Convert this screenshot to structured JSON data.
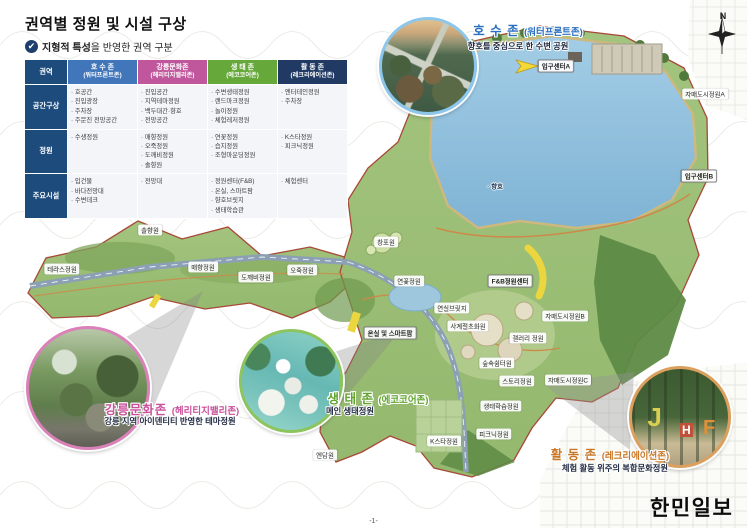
{
  "page": {
    "title": "권역별 정원 및 시설 구상",
    "subtitle_bold": "지형적 특성",
    "subtitle_rest": "을 반영한 권역 구분",
    "check": "✔",
    "compass_n": "N",
    "page_number": "-1-",
    "logo": "한민일보"
  },
  "table": {
    "corner": "권역",
    "rows": [
      "공간구상",
      "정원",
      "주요시설"
    ],
    "zones": [
      {
        "name": "호 수 존",
        "subname": "(워터프론트존)",
        "header_color": "#4276ba",
        "space": [
          "호공간",
          "진입광장",
          "주차장",
          "주문진 전망공간"
        ],
        "gardens": [
          "수생정원"
        ],
        "facilities": [
          "입건물",
          "바다전망대",
          "수변데크"
        ]
      },
      {
        "name": "강릉문화존",
        "subname": "(헤리티지밸리존)",
        "header_color": "#c0569c",
        "space": [
          "진입공간",
          "지역테마정원",
          "백두대간·향호",
          "전망공간"
        ],
        "gardens": [
          "매향정원",
          "오죽정원",
          "도깨비정원",
          "솔향원"
        ],
        "facilities": [
          "전망대"
        ]
      },
      {
        "name": "생 태 존",
        "subname": "(에코코어존)",
        "header_color": "#66a93a",
        "space": [
          "수변생태정원",
          "랜드마크정원",
          "놀이정원",
          "체험레저정원"
        ],
        "gardens": [
          "연꽃정원",
          "습지정원",
          "조형마운딩정원"
        ],
        "facilities": [
          "정원센터(F&B)",
          "온실, 스마트팜",
          "향호브릿지",
          "생태학습관"
        ]
      },
      {
        "name": "활 동 존",
        "subname": "(레크리에이션존)",
        "header_color": "#203a64",
        "space": [
          "엔터테인정원",
          "주차장"
        ],
        "gardens": [
          "K스타정원",
          "피크닉정원"
        ],
        "facilities": [
          "체험센터"
        ]
      }
    ]
  },
  "callouts": [
    {
      "title": "호 수 존",
      "subname": "(워터프론트존)",
      "desc": "향호를 중심으로 한 수변 공원",
      "color": "#2a6fc0",
      "ring": "#8cc6ea"
    },
    {
      "title": "강릉문화존",
      "subname": "(헤리티지밸리존)",
      "desc": "강릉 지역 아이덴티티 반영한 테마정원",
      "color": "#c9519b",
      "ring": "#d981b8"
    },
    {
      "title": "생 태 존",
      "subname": "(에코코어존)",
      "desc": "메인 생태정원",
      "color": "#5fa32c",
      "ring": "#8cc45e"
    },
    {
      "title": "활 동 존",
      "subname": "(레크리에이션존)",
      "desc": "체험 활동 위주의 복합문화정원",
      "color": "#c87828",
      "ring": "#dba05e"
    }
  ],
  "photo_letters": [
    "J",
    "H",
    "F"
  ],
  "map_labels": [
    {
      "text": "입구센터A",
      "x": 556,
      "y": 66,
      "kind": "box"
    },
    {
      "text": "자매도시정원A",
      "x": 705,
      "y": 94
    },
    {
      "text": "입구센터B",
      "x": 699,
      "y": 176,
      "kind": "box"
    },
    {
      "text": "· 향호",
      "x": 495,
      "y": 186,
      "kind": "plain"
    },
    {
      "text": "솔향원",
      "x": 150,
      "y": 230
    },
    {
      "text": "창포원",
      "x": 386,
      "y": 242
    },
    {
      "text": "테라스정원",
      "x": 62,
      "y": 269
    },
    {
      "text": "매향정원",
      "x": 203,
      "y": 267
    },
    {
      "text": "도깨비정원",
      "x": 256,
      "y": 277
    },
    {
      "text": "오죽정원",
      "x": 302,
      "y": 270
    },
    {
      "text": "연꽃정원",
      "x": 409,
      "y": 281
    },
    {
      "text": "F&B정원센터",
      "x": 510,
      "y": 281,
      "kind": "box"
    },
    {
      "text": "연실브릿지",
      "x": 452,
      "y": 308
    },
    {
      "text": "자매도시정원B",
      "x": 565,
      "y": 316
    },
    {
      "text": "사계절초화원",
      "x": 468,
      "y": 326
    },
    {
      "text": "온실 및 스마트팜",
      "x": 390,
      "y": 333,
      "kind": "box"
    },
    {
      "text": "갤러리 정원",
      "x": 528,
      "y": 338
    },
    {
      "text": "숲속쉼터원",
      "x": 497,
      "y": 363
    },
    {
      "text": "스토리정원",
      "x": 517,
      "y": 381
    },
    {
      "text": "자매도시정원C",
      "x": 568,
      "y": 380
    },
    {
      "text": "생태학습정원",
      "x": 501,
      "y": 406
    },
    {
      "text": "피크닉정원",
      "x": 494,
      "y": 434
    },
    {
      "text": "K스타정원",
      "x": 444,
      "y": 441
    },
    {
      "text": "엔담원",
      "x": 325,
      "y": 455
    }
  ]
}
